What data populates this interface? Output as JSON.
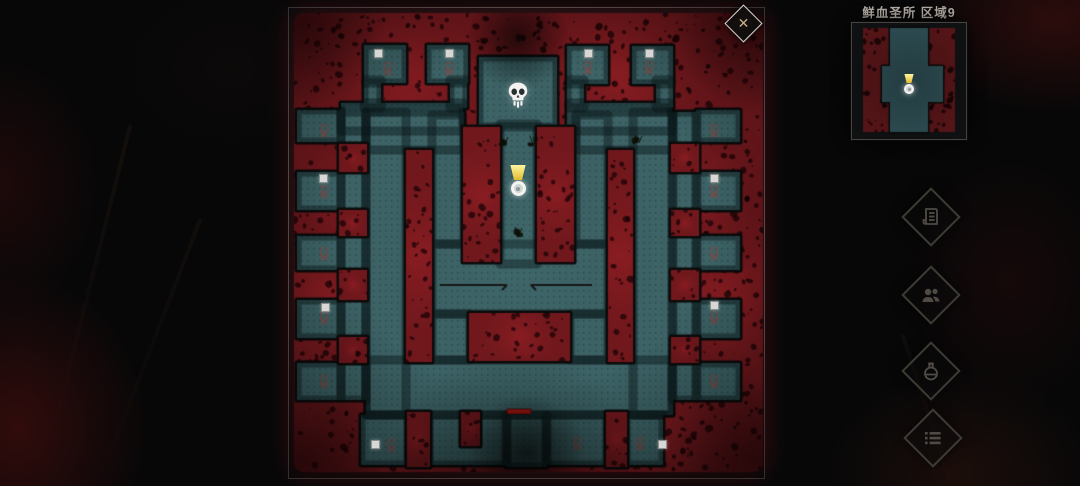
{
  "sidebar": {
    "area_title": "鲜血圣所 区域9",
    "buttons": [
      {
        "name": "journal",
        "icon": "scroll-icon"
      },
      {
        "name": "party",
        "icon": "people-icon"
      },
      {
        "name": "potion",
        "icon": "potion-icon"
      },
      {
        "name": "menu",
        "icon": "list-icon"
      }
    ],
    "button_centers": [
      [
        931,
        217
      ],
      [
        931,
        295
      ],
      [
        931,
        371
      ],
      [
        933,
        438
      ]
    ]
  },
  "map_panel": {
    "close_glyph": "✕",
    "panel_rect": [
      288,
      7,
      477,
      472
    ]
  },
  "map": {
    "palette": {
      "panel_bg": "#101012",
      "red_base": "#771a1f",
      "red_light": "rgba(185,38,44,0.30)",
      "red_glow": "rgba(120,16,20,0.55)",
      "speck": "rgba(26,3,6,0.75)",
      "teal": "#3d6366",
      "teal_dot": "rgba(10,26,28,0.32)",
      "outline": "#0b0b0b",
      "rune": "rgba(168,64,56,0.5)",
      "arrow": "#161616",
      "door_red": "#bf1b15"
    },
    "blob": [
      294,
      13,
      469,
      459
    ],
    "floor_rects": [
      [
        364,
        45,
        42,
        38
      ],
      [
        427,
        45,
        41,
        38
      ],
      [
        567,
        46,
        41,
        38
      ],
      [
        632,
        46,
        41,
        38
      ],
      [
        364,
        80,
        17,
        28
      ],
      [
        450,
        80,
        17,
        28
      ],
      [
        567,
        80,
        17,
        28
      ],
      [
        656,
        80,
        17,
        28
      ],
      [
        341,
        103,
        122,
        28
      ],
      [
        567,
        103,
        105,
        28
      ],
      [
        479,
        57,
        78,
        70
      ],
      [
        500,
        124,
        37,
        140
      ],
      [
        366,
        112,
        98,
        38
      ],
      [
        576,
        112,
        97,
        38
      ],
      [
        366,
        112,
        40,
        303
      ],
      [
        633,
        112,
        40,
        303
      ],
      [
        341,
        112,
        25,
        288
      ],
      [
        672,
        112,
        25,
        288
      ],
      [
        432,
        115,
        32,
        129
      ],
      [
        576,
        115,
        32,
        129
      ],
      [
        432,
        314,
        38,
        46
      ],
      [
        570,
        314,
        38,
        46
      ],
      [
        297,
        110,
        44,
        32
      ],
      [
        297,
        172,
        44,
        38
      ],
      [
        297,
        236,
        44,
        34
      ],
      [
        297,
        300,
        44,
        38
      ],
      [
        297,
        363,
        44,
        37
      ],
      [
        696,
        110,
        44,
        32
      ],
      [
        696,
        172,
        44,
        38
      ],
      [
        696,
        236,
        44,
        34
      ],
      [
        696,
        300,
        44,
        38
      ],
      [
        696,
        363,
        44,
        37
      ],
      [
        432,
        244,
        176,
        70
      ],
      [
        366,
        360,
        306,
        55
      ],
      [
        361,
        415,
        47,
        50
      ],
      [
        429,
        415,
        78,
        50
      ],
      [
        546,
        415,
        61,
        50
      ],
      [
        626,
        415,
        37,
        50
      ],
      [
        506,
        415,
        41,
        52
      ]
    ],
    "red_rects": [
      [
        406,
        150,
        26,
        212
      ],
      [
        608,
        150,
        25,
        212
      ],
      [
        463,
        127,
        37,
        135
      ],
      [
        537,
        127,
        37,
        135
      ],
      [
        469,
        313,
        101,
        48
      ],
      [
        339,
        144,
        28,
        28
      ],
      [
        339,
        210,
        28,
        26
      ],
      [
        339,
        270,
        28,
        30
      ],
      [
        339,
        337,
        28,
        26
      ],
      [
        671,
        144,
        28,
        28
      ],
      [
        671,
        210,
        28,
        26
      ],
      [
        671,
        270,
        28,
        30
      ],
      [
        671,
        337,
        28,
        26
      ],
      [
        407,
        412,
        23,
        55
      ],
      [
        461,
        412,
        19,
        34
      ],
      [
        606,
        412,
        21,
        55
      ]
    ],
    "lights": [
      [
        400,
        70,
        140
      ],
      [
        620,
        70,
        140
      ],
      [
        330,
        300,
        130
      ],
      [
        725,
        300,
        140
      ],
      [
        430,
        435,
        120
      ],
      [
        645,
        430,
        120
      ],
      [
        355,
        195,
        95
      ],
      [
        690,
        195,
        95
      ]
    ],
    "shades": [
      [
        300,
        25,
        85
      ],
      [
        758,
        25,
        85
      ],
      [
        300,
        462,
        85
      ],
      [
        758,
        462,
        85
      ]
    ],
    "fog": [
      [
        518,
        38,
        52,
        0.65
      ],
      [
        527,
        452,
        58,
        0.6
      ],
      [
        515,
        478,
        130,
        0.42
      ]
    ],
    "wall_lines": [
      [
        440,
        285,
        507,
        285
      ],
      [
        531,
        285,
        592,
        285
      ]
    ],
    "door": [
      507,
      409,
      24,
      5
    ],
    "skull": {
      "x": 518,
      "y": 95
    },
    "player": {
      "x": 518,
      "y": 185
    },
    "item_squares": [
      [
        377,
        52
      ],
      [
        448,
        52
      ],
      [
        587,
        52
      ],
      [
        648,
        52
      ],
      [
        322,
        177
      ],
      [
        324,
        306
      ],
      [
        713,
        177
      ],
      [
        713,
        304
      ],
      [
        374,
        443
      ],
      [
        661,
        443
      ]
    ],
    "runes": [
      [
        388,
        69
      ],
      [
        449,
        69
      ],
      [
        588,
        68
      ],
      [
        649,
        68
      ],
      [
        324,
        131
      ],
      [
        324,
        192
      ],
      [
        324,
        254
      ],
      [
        324,
        318
      ],
      [
        324,
        382
      ],
      [
        714,
        131
      ],
      [
        714,
        192
      ],
      [
        714,
        254
      ],
      [
        714,
        318
      ],
      [
        714,
        382
      ],
      [
        391,
        446
      ],
      [
        577,
        444
      ],
      [
        640,
        444
      ]
    ],
    "plants": [
      [
        504,
        141
      ],
      [
        533,
        141
      ],
      [
        518,
        232
      ],
      [
        638,
        140
      ]
    ]
  },
  "minimap": {
    "box": [
      851,
      22,
      116,
      118
    ],
    "bg": "#0f1112",
    "red": "#5a1619",
    "teal": "#2f5056",
    "red_rects": [
      [
        863,
        28,
        27,
        104
      ],
      [
        928,
        28,
        27,
        104
      ]
    ],
    "floor_rects": [
      [
        890,
        28,
        38,
        104
      ],
      [
        882,
        66,
        61,
        36
      ]
    ],
    "player": {
      "x": 909,
      "y": 84
    }
  }
}
